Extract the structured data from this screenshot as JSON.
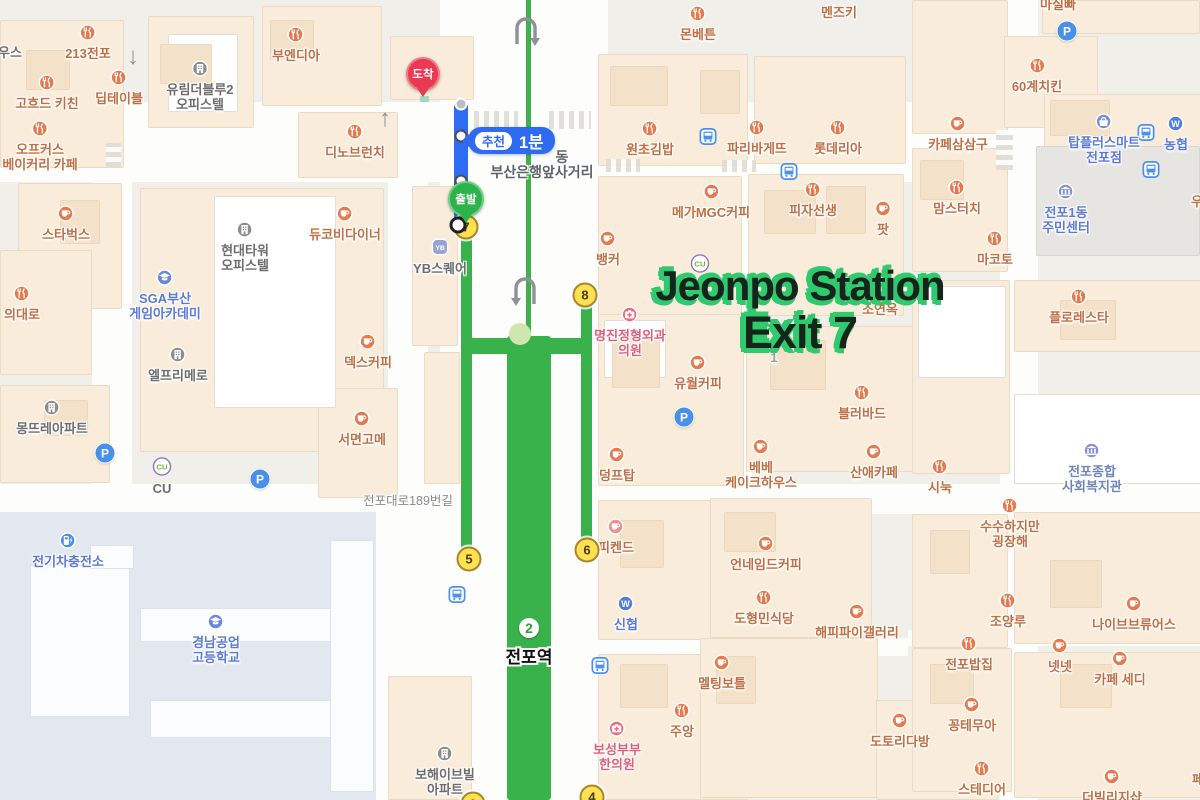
{
  "annotation": {
    "line1": "Jeonpo Station",
    "line2": "Exit 7",
    "fill": "#16251c",
    "shadow": "#2fca6e"
  },
  "route": {
    "recommend": "추천",
    "duration": "1분",
    "start_label": "출발",
    "arrive_label": "도착"
  },
  "station": {
    "line_number": "2",
    "name": "전포역"
  },
  "road_labels": [
    {
      "text": "전포대로189번길",
      "x": 408,
      "y": 490,
      "big": false
    },
    {
      "text": "부산은행앞사거리",
      "x": 542,
      "y": 162,
      "big": true
    },
    {
      "text": "동",
      "x": 562,
      "y": 147,
      "big": true
    }
  ],
  "exits": [
    {
      "n": "7",
      "x": 466,
      "y": 227
    },
    {
      "n": "8",
      "x": 585,
      "y": 295
    },
    {
      "n": "5",
      "x": 469,
      "y": 559
    },
    {
      "n": "6",
      "x": 587,
      "y": 550
    },
    {
      "n": "4",
      "x": 592,
      "y": 797
    },
    {
      "n": "3",
      "x": 473,
      "y": 804
    }
  ],
  "pois": [
    {
      "t": [
        "우스"
      ],
      "x": 10,
      "iy": 36,
      "i": "none",
      "c": "gray"
    },
    {
      "t": [
        "213전포"
      ],
      "x": 88,
      "iy": 33,
      "i": "food"
    },
    {
      "t": [
        "고흐드 키친"
      ],
      "x": 47,
      "iy": 83,
      "i": "food"
    },
    {
      "t": [
        "딥테이블"
      ],
      "x": 119,
      "iy": 78,
      "i": "food"
    },
    {
      "t": [
        "오프커스",
        "베이커리 카페"
      ],
      "x": 40,
      "iy": 129,
      "i": "food"
    },
    {
      "t": [
        "유림더블루2",
        "오피스텔"
      ],
      "x": 200,
      "iy": 69,
      "i": "building",
      "c": "gray"
    },
    {
      "t": [
        "부엔디아"
      ],
      "x": 296,
      "iy": 35,
      "i": "food"
    },
    {
      "t": [
        "디노브런치"
      ],
      "x": 355,
      "iy": 132,
      "i": "food"
    },
    {
      "t": [
        "스타벅스"
      ],
      "x": 66,
      "iy": 214,
      "i": "cafe"
    },
    {
      "t": [
        "의대로"
      ],
      "x": 22,
      "iy": 294,
      "i": "food"
    },
    {
      "t": [
        "SGA부산",
        "게임아카데미"
      ],
      "x": 165,
      "iy": 278,
      "i": "school",
      "c": "blue"
    },
    {
      "t": [
        "현대타워",
        "오피스텔"
      ],
      "x": 245,
      "iy": 230,
      "i": "building",
      "c": "gray"
    },
    {
      "t": [
        "엘프리메로"
      ],
      "x": 178,
      "iy": 355,
      "i": "building",
      "c": "gray"
    },
    {
      "t": [
        "듀코비다이너"
      ],
      "x": 345,
      "iy": 214,
      "i": "cafe"
    },
    {
      "t": [
        "YB스퀘어"
      ],
      "x": 440,
      "iy": 247,
      "i": "yb",
      "c": "gray"
    },
    {
      "t": [
        "덱스커피"
      ],
      "x": 368,
      "iy": 342,
      "i": "cafe"
    },
    {
      "t": [
        "서면고메"
      ],
      "x": 362,
      "iy": 419,
      "i": "cafe"
    },
    {
      "t": [
        "몽뜨레아파트"
      ],
      "x": 52,
      "iy": 408,
      "i": "apt",
      "c": "gray"
    },
    {
      "t": [
        "CU"
      ],
      "x": 162,
      "iy": 466,
      "i": "cu",
      "c": "gray"
    },
    {
      "t": [
        "전기차충전소"
      ],
      "x": 68,
      "iy": 541,
      "i": "ev",
      "c": "blue"
    },
    {
      "t": [
        "경남공업",
        "고등학교"
      ],
      "x": 216,
      "iy": 622,
      "i": "school",
      "c": "blue"
    },
    {
      "t": [
        "보해이브빌",
        "아파트"
      ],
      "x": 445,
      "iy": 754,
      "i": "apt",
      "c": "gray"
    },
    {
      "t": [
        "몬베튼"
      ],
      "x": 698,
      "iy": 14,
      "i": "food"
    },
    {
      "t": [
        "멘즈키"
      ],
      "x": 839,
      "iy": -4,
      "i": "none"
    },
    {
      "t": [
        "마실빠"
      ],
      "x": 1058,
      "iy": -12,
      "i": "none"
    },
    {
      "t": [
        "원초김밥"
      ],
      "x": 650,
      "iy": 129,
      "i": "food"
    },
    {
      "t": [
        "파리바게뜨"
      ],
      "x": 757,
      "iy": 128,
      "i": "food"
    },
    {
      "t": [
        "롯데리아"
      ],
      "x": 838,
      "iy": 128,
      "i": "food"
    },
    {
      "t": [
        "60계치킨"
      ],
      "x": 1037,
      "iy": 66,
      "i": "food"
    },
    {
      "t": [
        "카페삼삼구"
      ],
      "x": 958,
      "iy": 124,
      "i": "cafe"
    },
    {
      "t": [
        "탑플러스마트",
        "전포점"
      ],
      "x": 1104,
      "iy": 122,
      "i": "shop",
      "c": "blue"
    },
    {
      "t": [
        "농협"
      ],
      "x": 1176,
      "iy": 124,
      "i": "bankW",
      "c": "blue"
    },
    {
      "t": [
        "메가MGC커피"
      ],
      "x": 711,
      "iy": 192,
      "i": "cafe"
    },
    {
      "t": [
        "피자선생"
      ],
      "x": 813,
      "iy": 190,
      "i": "food"
    },
    {
      "t": [
        "팟"
      ],
      "x": 883,
      "iy": 209,
      "i": "cafe"
    },
    {
      "t": [
        "맘스터치"
      ],
      "x": 957,
      "iy": 188,
      "i": "food"
    },
    {
      "t": [
        "마코토"
      ],
      "x": 995,
      "iy": 239,
      "i": "food"
    },
    {
      "t": [
        "전포1동",
        "주민센터"
      ],
      "x": 1066,
      "iy": 192,
      "i": "public",
      "c": "blue"
    },
    {
      "t": [
        "우"
      ],
      "x": 1197,
      "iy": 185,
      "i": "none"
    },
    {
      "t": [
        "뱅커"
      ],
      "x": 608,
      "iy": 239,
      "i": "cafe"
    },
    {
      "t": [],
      "x": 700,
      "iy": 263,
      "i": "cu"
    },
    {
      "t": [
        "소연옥"
      ],
      "x": 880,
      "iy": 293,
      "i": "none"
    },
    {
      "t": [
        "명진정형외과",
        "의원"
      ],
      "x": 630,
      "iy": 315,
      "i": "hospital",
      "c": "rose"
    },
    {
      "t": [
        "1"
      ],
      "x": 774,
      "iy": 341,
      "i": "none",
      "c": "dim"
    },
    {
      "t": [
        "유월커피"
      ],
      "x": 698,
      "iy": 363,
      "i": "cafe"
    },
    {
      "t": [
        "블러바드"
      ],
      "x": 862,
      "iy": 393,
      "i": "food"
    },
    {
      "t": [
        "덩프탑"
      ],
      "x": 617,
      "iy": 455,
      "i": "cafe"
    },
    {
      "t": [
        "베베",
        "케이크하우스"
      ],
      "x": 761,
      "iy": 447,
      "i": "cafe"
    },
    {
      "t": [
        "산애카페"
      ],
      "x": 874,
      "iy": 452,
      "i": "cafe"
    },
    {
      "t": [
        "시눅"
      ],
      "x": 940,
      "iy": 467,
      "i": "food"
    },
    {
      "t": [
        "전포종합",
        "사회복지관"
      ],
      "x": 1092,
      "iy": 451,
      "i": "public",
      "c": "steel"
    },
    {
      "t": [
        "수수하지만",
        "굉장해"
      ],
      "x": 1010,
      "iy": 506,
      "i": "food"
    },
    {
      "t": [
        "플로레스타"
      ],
      "x": 1079,
      "iy": 297,
      "i": "food"
    },
    {
      "t": [
        "피켄드"
      ],
      "x": 616,
      "iy": 527,
      "i": "dessert"
    },
    {
      "t": [
        "언네임드커피"
      ],
      "x": 766,
      "iy": 544,
      "i": "cafe"
    },
    {
      "t": [
        "신협"
      ],
      "x": 626,
      "iy": 604,
      "i": "bankW",
      "c": "blue"
    },
    {
      "t": [
        "도형민식당"
      ],
      "x": 764,
      "iy": 598,
      "i": "food"
    },
    {
      "t": [
        "해피파이갤러리"
      ],
      "x": 857,
      "iy": 612,
      "i": "cafe"
    },
    {
      "t": [
        "멜팅보틀"
      ],
      "x": 722,
      "iy": 663,
      "i": "cafe"
    },
    {
      "t": [
        "주앙"
      ],
      "x": 682,
      "iy": 711,
      "i": "food"
    },
    {
      "t": [
        "보성부부",
        "한의원"
      ],
      "x": 617,
      "iy": 729,
      "i": "hospital",
      "c": "rose"
    },
    {
      "t": [
        "도토리다방"
      ],
      "x": 900,
      "iy": 721,
      "i": "cafe"
    },
    {
      "t": [
        "조양루"
      ],
      "x": 1008,
      "iy": 601,
      "i": "food"
    },
    {
      "t": [
        "나이브브류어스"
      ],
      "x": 1134,
      "iy": 604,
      "i": "cafe"
    },
    {
      "t": [
        "전포밥집"
      ],
      "x": 969,
      "iy": 644,
      "i": "food"
    },
    {
      "t": [
        "넷넷"
      ],
      "x": 1060,
      "iy": 646,
      "i": "cafe"
    },
    {
      "t": [
        "카페 세디"
      ],
      "x": 1120,
      "iy": 659,
      "i": "cafe"
    },
    {
      "t": [
        "꽁테무아"
      ],
      "x": 972,
      "iy": 705,
      "i": "cafe"
    },
    {
      "t": [
        "스테디어"
      ],
      "x": 982,
      "iy": 769,
      "i": "food"
    },
    {
      "t": [
        "더빌리지샵"
      ],
      "x": 1112,
      "iy": 777,
      "i": "cafe"
    },
    {
      "t": [
        "페"
      ],
      "x": 1198,
      "iy": 763,
      "i": "none"
    }
  ],
  "bus_stops": [
    [
      708,
      139
    ],
    [
      789,
      174
    ],
    [
      1146,
      135
    ],
    [
      1151,
      172
    ],
    [
      457,
      597
    ],
    [
      600,
      668
    ]
  ],
  "parking": [
    [
      105,
      453
    ],
    [
      260,
      479
    ],
    [
      684,
      417
    ],
    [
      1067,
      31
    ]
  ],
  "colors": {
    "route_green": "#39b24b",
    "route_blue": "#2e6cf2",
    "badge_blue": "#2f6bf0",
    "exit_yellow": "#ffe151",
    "arrive_red": "#e83a52",
    "depart_green": "#2cb44a",
    "poi_orange": "#e57a4e",
    "poi_blue": "#6b86e0"
  }
}
